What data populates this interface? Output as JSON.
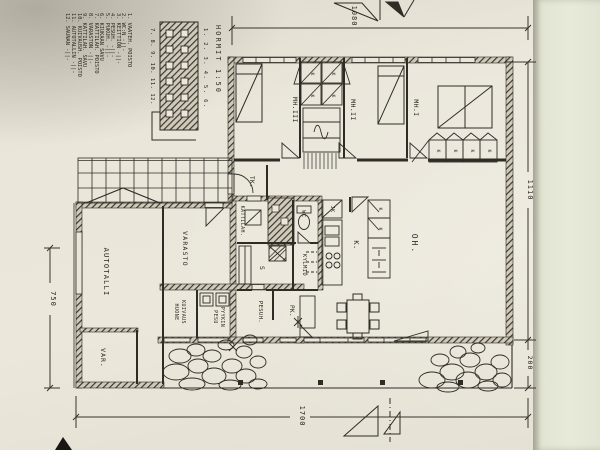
{
  "legend": {
    "items": [
      "1. VAATEH. POISTO",
      "2. WC:N  -||-",
      "3. KEITTIÖN  -||-",
      "4. PESUH.  -||-",
      "5. PUKUH.  -||-",
      "6. KIUKAAN SAVU",
      "7. KATTILAH. POISTO",
      "8. VARASTON  -||-",
      "9. KATTILAH. SAVU",
      "10. KUIVAUSH. POISTO",
      "11. AUTOTALLIN  -||-",
      "12. SAUNAN  -||-"
    ]
  },
  "hormit": {
    "title": "HORMIT 1:50",
    "flues_right": "1. 2. 3. 4. 5. 6.",
    "flues_left": "7. 8. 9. 10. 11. 12."
  },
  "rooms": {
    "autotalli": "AUTOTALLI",
    "varasto": "VARASTO",
    "var": "VAR.",
    "kuivaus_1": "KUIVAUS",
    "kuivaus_2": "HUONE",
    "pyykki_1": "PYYKIN",
    "pyykki_2": "PESU",
    "pesuh": "PESUH.",
    "pk": "PK.",
    "sauna": "S",
    "kylmio": "KYLMIÖ",
    "wc": "WC",
    "kattilah": "KATTILAH.",
    "tk": "TK.",
    "jk": "JK",
    "keittio": "K.",
    "oh": "OH.",
    "mh1": "MH.I",
    "mh2": "MH.II",
    "mh3": "MH.III",
    "closet_k": "K"
  },
  "dimensions": {
    "top": "1080",
    "right_upper": "1110",
    "right_lower": "200",
    "bottom": "1700",
    "left": "750"
  },
  "ink_color": "#2f2c26",
  "paper_color": "#e9e5d8"
}
